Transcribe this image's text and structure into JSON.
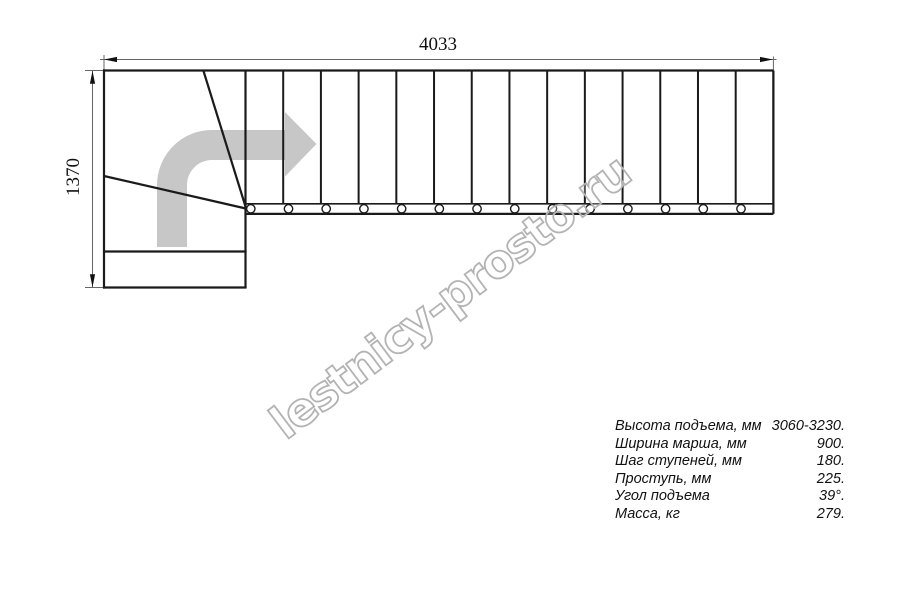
{
  "drawing": {
    "title_semantic": "stair-plan-top-view",
    "dimensions": {
      "total_length_mm": "4033",
      "total_depth_mm": "1370"
    },
    "plan": {
      "straight_steps": 14,
      "bolt_holes": 14,
      "winder_steps": 3,
      "line_color": "#1a1a1a",
      "dim_color": "#666666",
      "arrow_color": "#c7c7c7",
      "direction_arrow_icon": "curved-right-arrow"
    },
    "watermark": {
      "text": "lestnicy-prosto.ru",
      "outline_color": "#b3b3b3"
    },
    "specs": {
      "rows": [
        {
          "label": "Высота подъема, мм",
          "value": "3060-3230."
        },
        {
          "label": "Ширина марша, мм",
          "value": "900."
        },
        {
          "label": "Шаг ступеней, мм",
          "value": "180."
        },
        {
          "label": "Проступь, мм",
          "value": "225."
        },
        {
          "label": "Угол подъема",
          "value": "39°."
        },
        {
          "label": "Масса, кг",
          "value": "279."
        }
      ]
    }
  }
}
